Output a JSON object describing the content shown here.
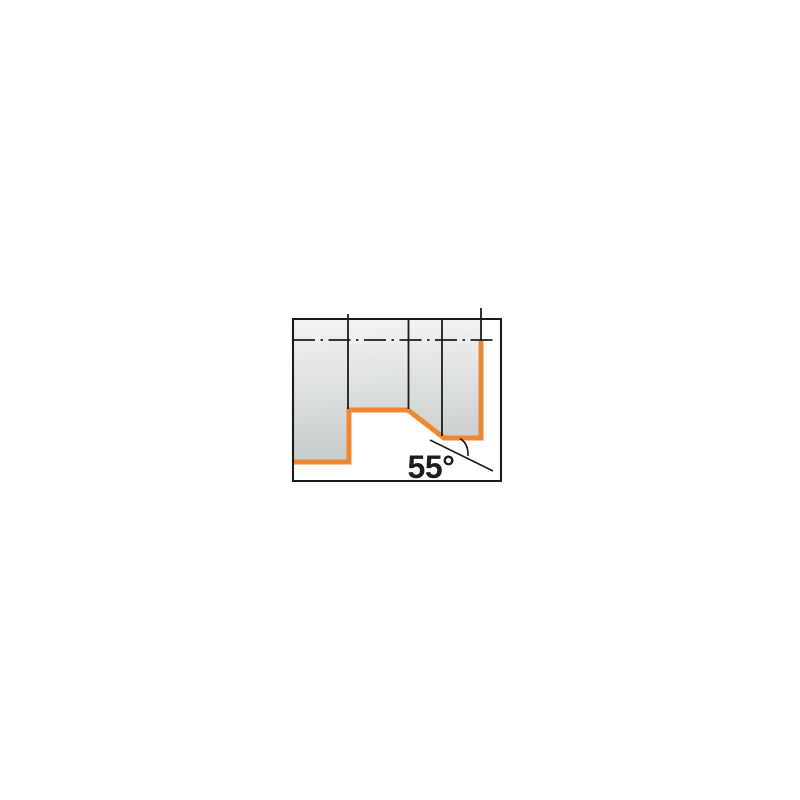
{
  "page": {
    "background": "#ffffff"
  },
  "diagram": {
    "type": "technical-drawing",
    "description": "Turning tool application diagram: stepped workpiece profile machined at a 55 degree entering angle, cut surfaces highlighted in orange, dash-dot workpiece centerline near top",
    "angle_label": "55°",
    "colors": {
      "outline": "#1c1c1c",
      "highlight_orange": "#ED8730",
      "fill_top": "#f3f4f4",
      "fill_bottom": "#c6caca",
      "background": "#ffffff"
    },
    "geometry": {
      "frame_path": "M 293 319 H 501 V 481 H 293 Z",
      "workpiece_path": "M 293 320 H 481 V 438 H 444 L 408 410 H 349 V 462 H 293 Z",
      "orange_profile_path": "M 293 462 H 349 V 410 H 408 L 444 438 H 481 V 341",
      "division_lines_path": "M 348 314 V 409 M 408.5 319 V 409 M 442 319 V 436 M 481 308 V 341",
      "centerline_path": "M 293 340 H 495",
      "angle_leg_path": "M 430 440 L 493 471",
      "angle_arc_path": "M 460 438.5 Q 468.5 443.5 468 456"
    }
  }
}
